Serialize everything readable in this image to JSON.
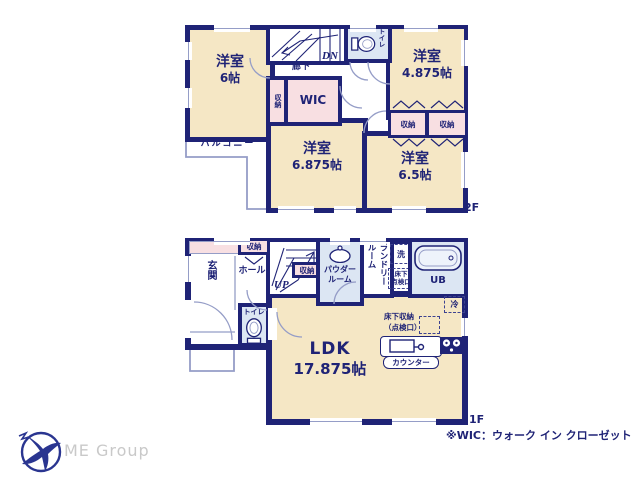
{
  "colors": {
    "wall_navy": "#1f2376",
    "room_beige": "#f5e7c5",
    "closet_pink": "#f8dfe2",
    "wet_area_blue": "#dce6f3",
    "thin_outline": "#959dc7",
    "logo_navy": "#2a3590",
    "logo_text_gray": "#c9c9c9"
  },
  "floor2": {
    "label": "2F",
    "rooms": [
      {
        "name": "洋室",
        "size": "6帖"
      },
      {
        "name": "洋室",
        "size": "4.875帖"
      },
      {
        "name": "洋室",
        "size": "6.875帖"
      },
      {
        "name": "洋室",
        "size": "6.5帖"
      }
    ],
    "corridor": "廊下",
    "down": "DN",
    "toilet": "トイレ",
    "wic": "WIC",
    "storage": "収納",
    "balcony": "バルコニー"
  },
  "floor1": {
    "label": "1F",
    "entrance": "玄関",
    "hall": "ホール",
    "up": "UP",
    "storage": "収納",
    "toilet": "トイレ",
    "powder_room": {
      "line1": "パウダー",
      "line2": "ルーム"
    },
    "laundry_room": "ランドリールーム",
    "washer": "洗",
    "underfloor_access": {
      "line1": "床下",
      "line2": "点検口"
    },
    "unit_bath": "UB",
    "fridge": "冷",
    "ldk": {
      "name": "LDK",
      "size": "17.875帖"
    },
    "underfloor_storage": {
      "line1": "床下収納",
      "line2": "（点検口）"
    },
    "counter": "カウンター"
  },
  "footer": {
    "logo": "ME Group",
    "note": "※WIC：ウォーク イン クローゼット"
  }
}
